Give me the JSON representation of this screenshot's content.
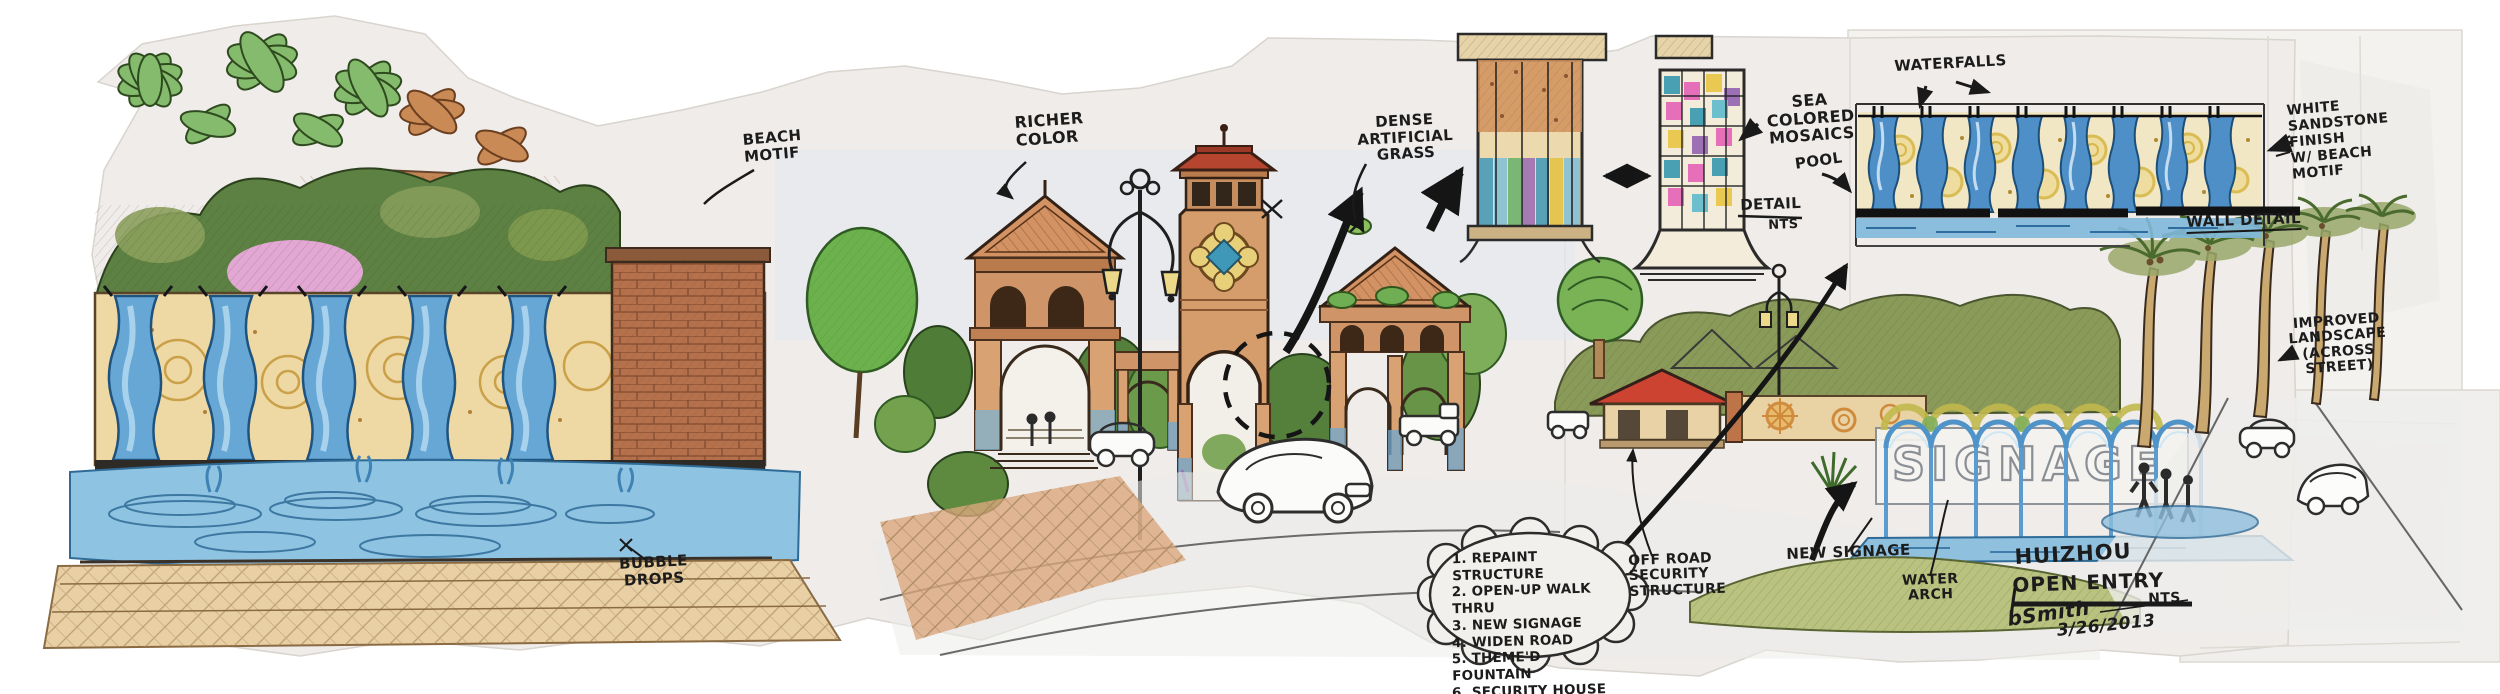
{
  "drawing": {
    "labels": {
      "beach_motif": "BEACH\nMOTIF",
      "richer_color": "RICHER\nCOLOR",
      "dense_artificial_grass": "DENSE ARTIFICIAL\nGRASS",
      "sea_colored_mosaics": "SEA COLORED\nMOSAICS",
      "pool": "POOL",
      "detail": "DETAIL",
      "detail_scale": "NTS",
      "waterfalls": "WATERFALLS",
      "white_sandstone_finish": "WHITE\nSANDSTONE\nFINISH\nW/ BEACH\nMOTIF",
      "wall_detail": "WALL DETAIL",
      "improved_landscape": "IMPROVED\nLANDSCAPE\n(ACROSS\nSTREET)",
      "bubble_drops": "BUBBLE\nDROPS",
      "off_road_security": "OFF ROAD\nSECURITY\nSTRUCTURE",
      "new_signage": "NEW SIGNAGE",
      "water_arch": "WATER\nARCH"
    },
    "notes": {
      "items": [
        "1. REPAINT STRUCTURE",
        "2. OPEN-UP WALK THRU",
        "3. NEW SIGNAGE",
        "4. WIDEN ROAD",
        "5. THEME'D FOUNTAIN",
        "6. SECURITY HOUSE"
      ]
    },
    "title_block": {
      "project": "HUIZHOU",
      "sheet": "OPEN ENTRY",
      "scale": "NTS",
      "signed_by": "bSmith",
      "date": "3/26/2013"
    },
    "signage_wall_text": "SIGNAGE",
    "palette": {
      "paper": "#efedea",
      "ink": "#1c1c1c",
      "water_blue": "#5b9cd0",
      "sand": "#ecd9a4",
      "terracotta": "#cf9468",
      "roof_red": "#b5452f",
      "foliage_green": "#6fae52",
      "mosaic_teal": "#2d93ad",
      "mosaic_pink": "#e35bb4",
      "lamp_yellow": "#ecd98a"
    }
  }
}
